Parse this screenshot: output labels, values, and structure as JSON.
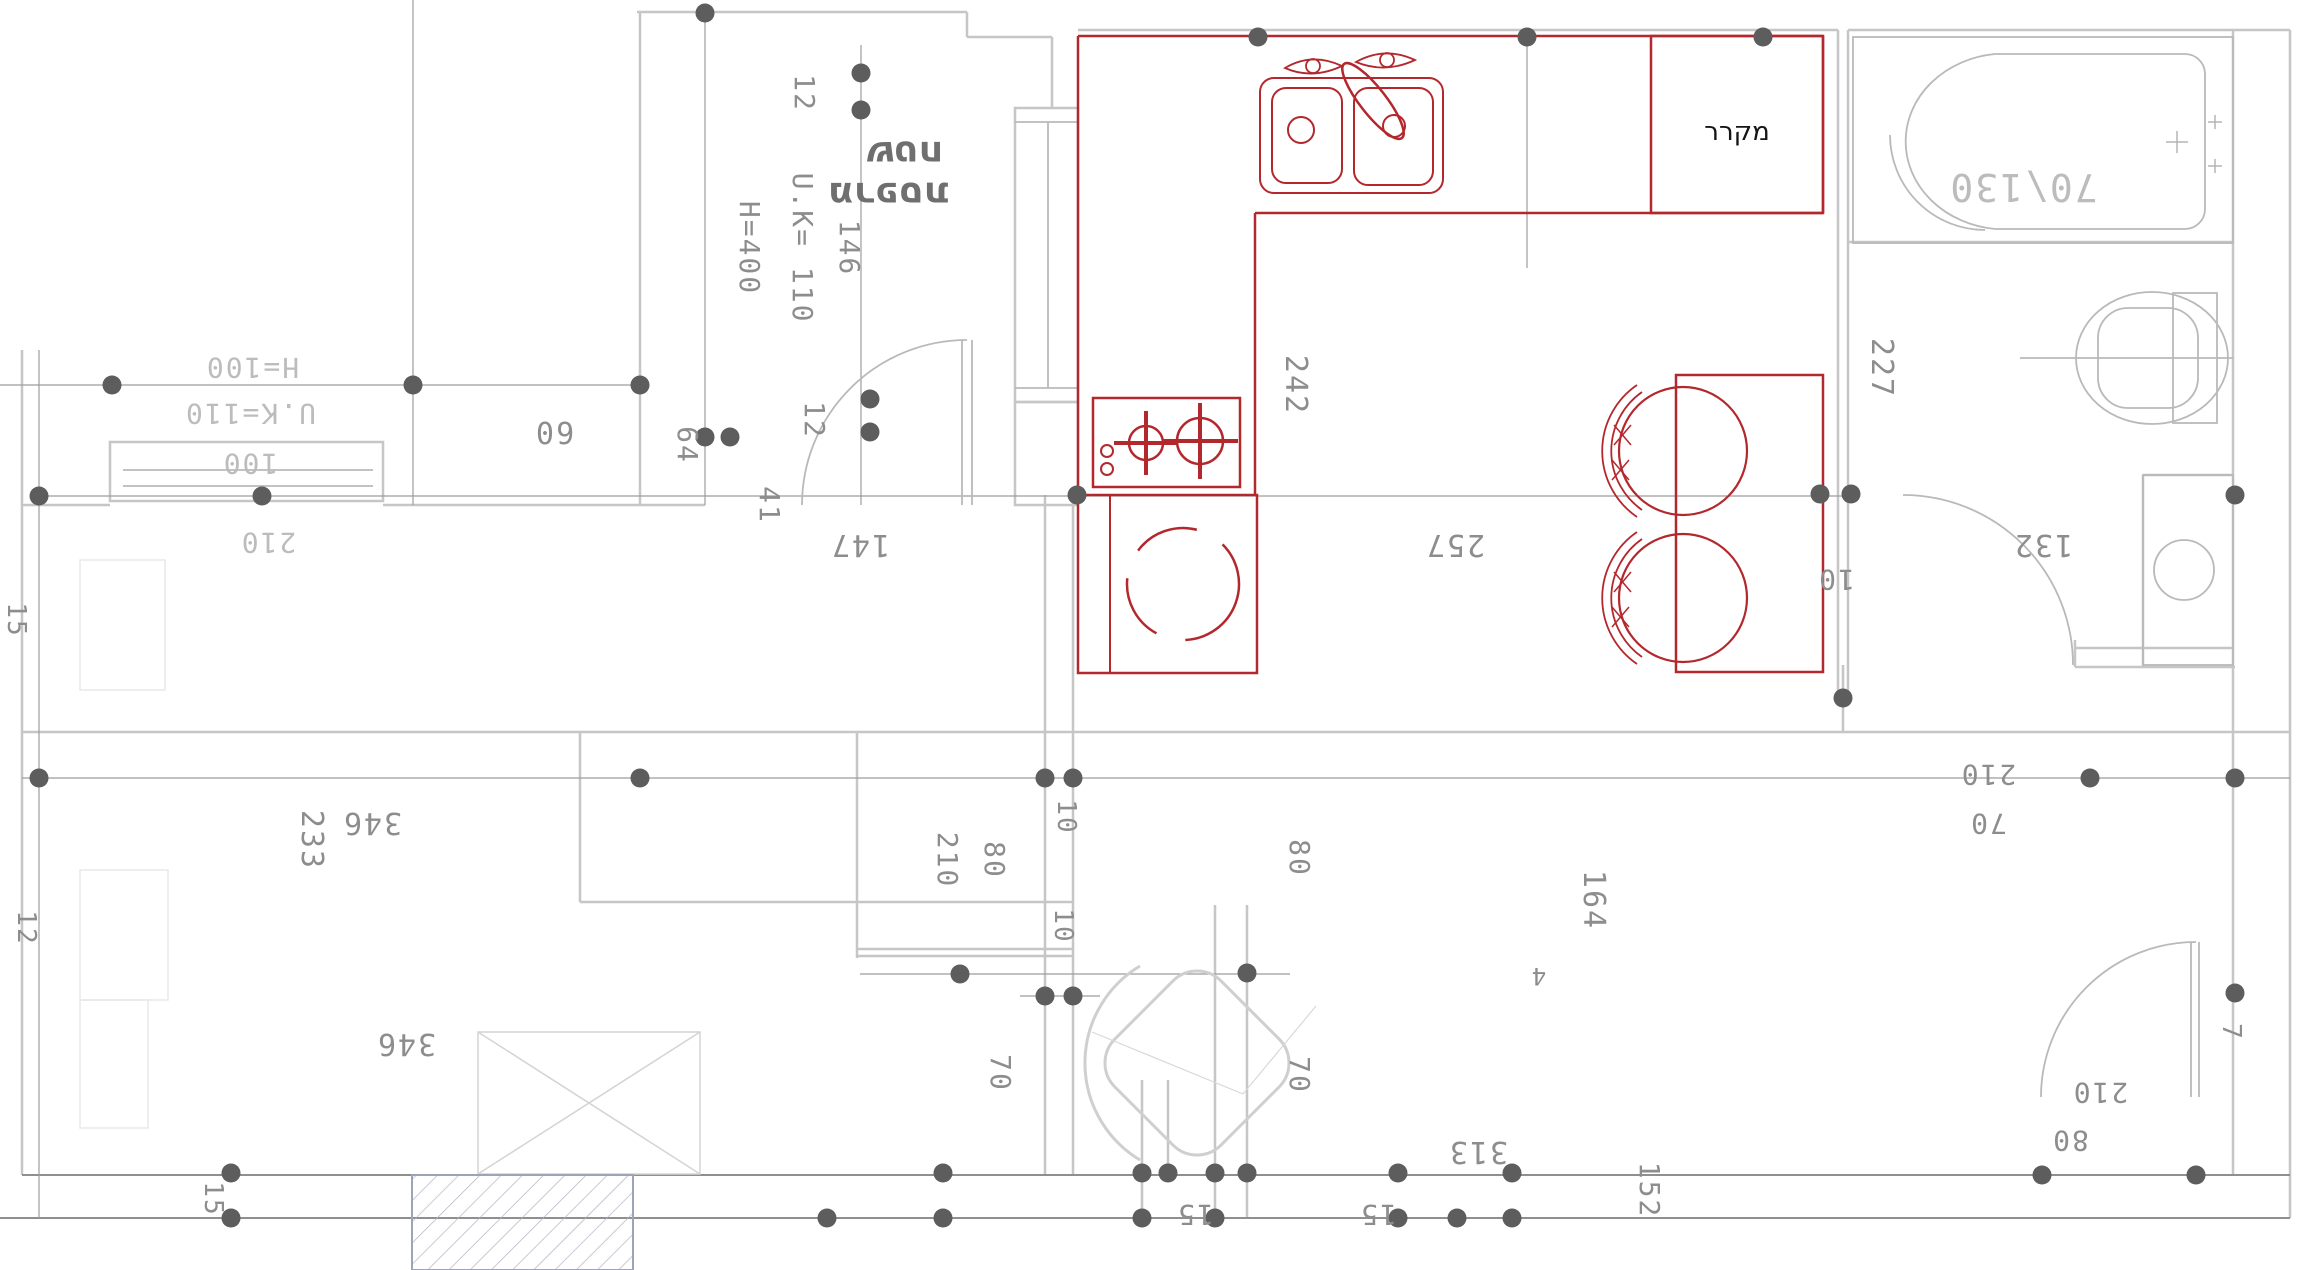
{
  "drawing": {
    "type": "architectural-floor-plan",
    "colors": {
      "background": "#ffffff",
      "wall": "#c6c6c6",
      "wall_dark": "#8f8f8f",
      "grid_line": "#9c9c9c",
      "junction_dot": "#5d5d5d",
      "fixture_red": "#b3282d",
      "faint_furniture": "#e8e8e8",
      "hatch_fill": "#a9adc0",
      "dim_text": "#8d8d8d",
      "dim_text_light": "#bcbcbc",
      "hebrew_text": "#6f6f6f",
      "black_text": "#151515"
    },
    "labels": {
      "balcony1": "שטח",
      "balcony2": "מרפסת",
      "fridge": "מקרר",
      "tub_size": "70\\130",
      "h100": "H=100",
      "uk110": "U.K=110",
      "n100": "100",
      "n210_win": "210",
      "n60": "60",
      "n12_top": "12",
      "uk110b": "U.K= 110",
      "n146": "146",
      "h400": "H=400",
      "n12_door": "12",
      "n41": "41",
      "n147": "147",
      "n64": "64",
      "n242": "242",
      "n257": "257",
      "n227": "227",
      "n10_fridge": "10",
      "n233": "233",
      "n346a": "346",
      "n346b": "346",
      "n210a": "210",
      "n80a": "80",
      "n10a": "10",
      "n10b": "10",
      "n80b": "80",
      "n70a": "70",
      "n70b": "70",
      "n164": "164",
      "n15_left": "15",
      "n12_left": "12",
      "n15_wall": "15",
      "n15a": "15",
      "n15b": "15",
      "n313": "313",
      "n152": "152",
      "n4": "4",
      "n210r": "210",
      "n70r": "70",
      "n210br": "210",
      "n80br": "80",
      "n7": "7",
      "n132": "132"
    }
  }
}
